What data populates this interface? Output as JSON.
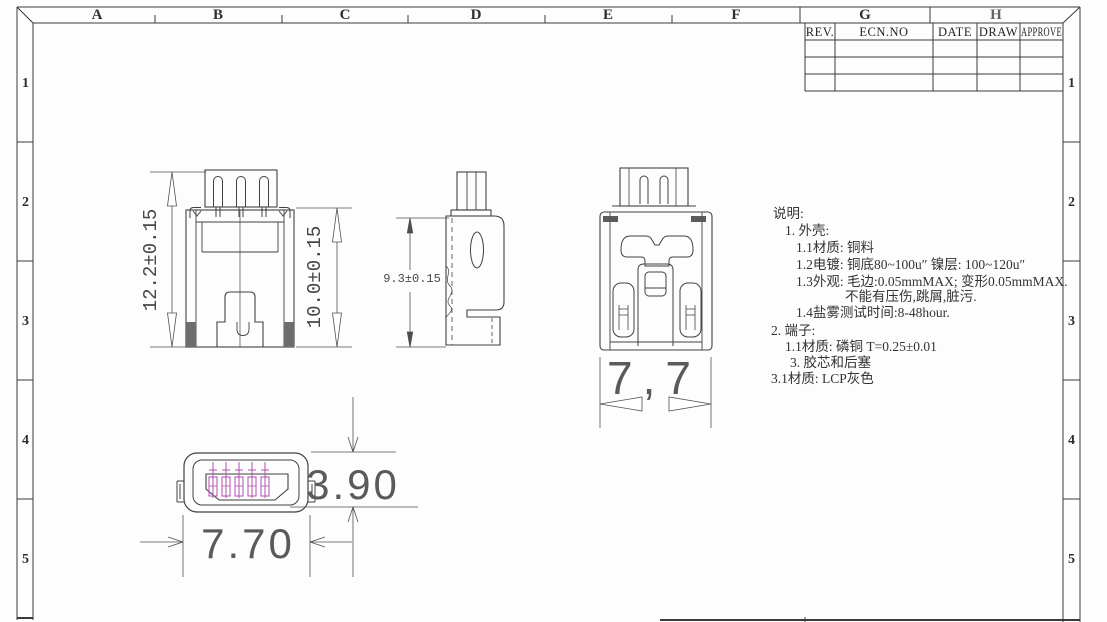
{
  "sheet": {
    "frame": {
      "columns": [
        "A",
        "B",
        "C",
        "D",
        "E",
        "F",
        "G",
        "H"
      ],
      "rows": [
        "1",
        "2",
        "3",
        "4",
        "5"
      ]
    },
    "title_block": {
      "headers": [
        "REV.",
        "ECN.NO",
        "DATE",
        "DRAW",
        "APPROVE"
      ],
      "empty_rows": 3
    }
  },
  "views": {
    "back_view": {
      "dim_overall_height": "12.2±0.15",
      "dim_body_height": "10.0±0.15"
    },
    "side_view": {
      "dim_height": "9.3±0.15"
    },
    "front_view": {
      "dim_width": "7,7"
    },
    "mating_face_view": {
      "dim_opening_height": "3.90",
      "dim_width": "7.70"
    }
  },
  "notes": {
    "lines": [
      "说明:",
      "1. 外壳:",
      "1.1材质: 铜料",
      "1.2电镀: 铜底80~100u″ 镍层: 100~120u″",
      "1.3外观: 毛边:0.05mmMAX; 变形0.05mmMAX.",
      "不能有压伤,跳屑,脏污.",
      "1.4盐雾测试时间:8-48hour.",
      "2. 端子:",
      "1.1材质: 磷铜 T=0.25±0.01",
      "3. 胶芯和后塞",
      "3.1材质: LCP灰色"
    ]
  },
  "colors": {
    "line": "#414141",
    "dimension": "#4f4f4f",
    "pin": "#b44fb4"
  }
}
